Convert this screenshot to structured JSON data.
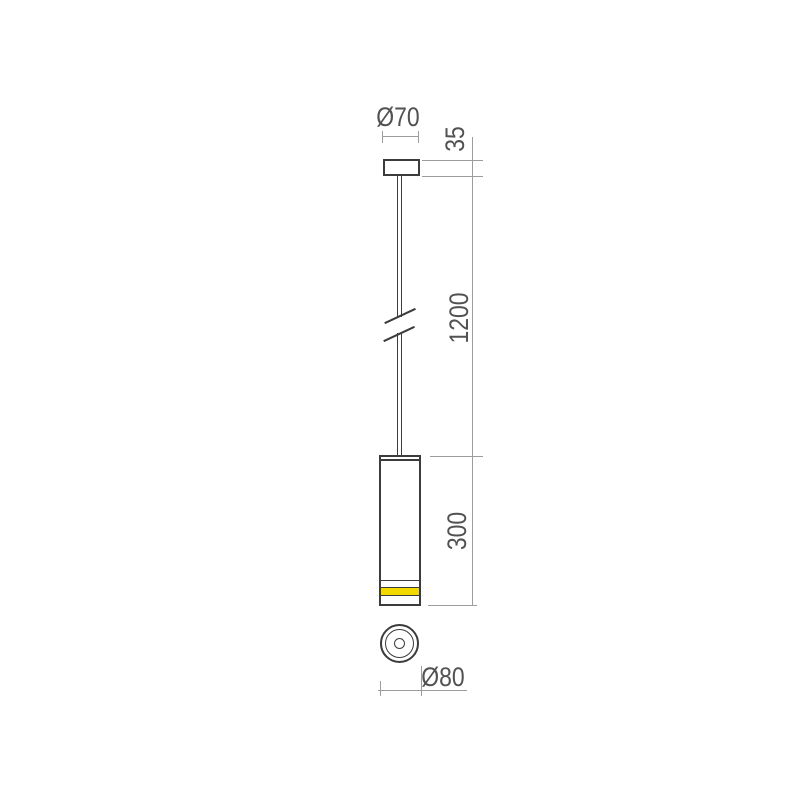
{
  "drawing": {
    "type": "technical-drawing",
    "views": [
      "front-elevation",
      "bottom-view"
    ],
    "colors": {
      "line": "#3c3c3c",
      "dim_line": "#9c9c9c",
      "text": "#525252",
      "accent_band": "#f2da00",
      "background": "#ffffff"
    },
    "dimensions": {
      "canopy_diameter": {
        "label": "Ø70",
        "value_mm": 70
      },
      "canopy_height": {
        "label": "35",
        "value_mm": 35
      },
      "suspension_length": {
        "label": "1200",
        "value_mm": 1200
      },
      "body_height": {
        "label": "300",
        "value_mm": 300
      },
      "body_diameter": {
        "label": "Ø80",
        "value_mm": 80
      }
    }
  }
}
